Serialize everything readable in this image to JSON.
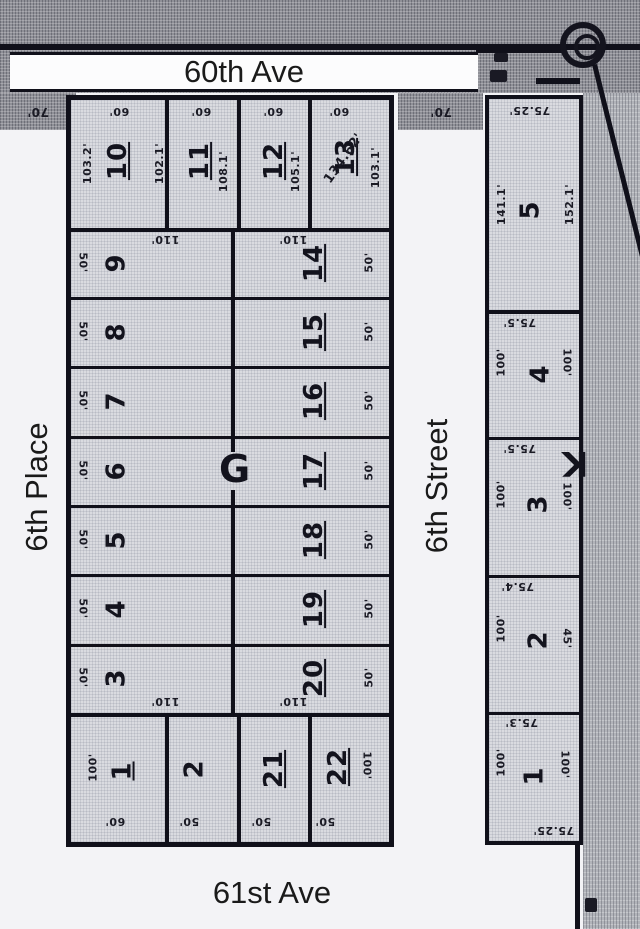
{
  "streets": {
    "top": "60th Ave",
    "west": "6th Place",
    "center": "6th Street",
    "bottom": "61st Ave"
  },
  "outer_dims": {
    "west_70": "70'",
    "center_70": "70'"
  },
  "block_g": {
    "label": "G",
    "north_row": [
      {
        "num": "10",
        "front": "60'",
        "west_depth": "103.2'",
        "east_depth": "102.1'"
      },
      {
        "num": "11",
        "front": "60'",
        "depth": "108.1'"
      },
      {
        "num": "12",
        "front": "60'",
        "depth": "105.1'"
      },
      {
        "num": "13",
        "front": "60'",
        "diagonal": "134.62'",
        "east_depth": "103.1'"
      }
    ],
    "west_lots": [
      {
        "num": "9",
        "front": "50'",
        "depth": "110'"
      },
      {
        "num": "8",
        "front": "50'"
      },
      {
        "num": "7",
        "front": "50'"
      },
      {
        "num": "6",
        "front": "50'"
      },
      {
        "num": "5",
        "front": "50'"
      },
      {
        "num": "4",
        "front": "50'"
      },
      {
        "num": "3",
        "front": "50'",
        "depth": "110'"
      }
    ],
    "east_lots": [
      {
        "num": "14",
        "front": "50'",
        "depth": "110'"
      },
      {
        "num": "15",
        "front": "50'"
      },
      {
        "num": "16",
        "front": "50'"
      },
      {
        "num": "17",
        "front": "50'"
      },
      {
        "num": "18",
        "front": "50'"
      },
      {
        "num": "19",
        "front": "50'"
      },
      {
        "num": "20",
        "front": "50'",
        "depth": "110'"
      }
    ],
    "south_row": [
      {
        "num": "1",
        "front": "60'",
        "side": "100'"
      },
      {
        "num": "2",
        "front": "50'"
      },
      {
        "num": "21",
        "front": "50'"
      },
      {
        "num": "22",
        "front": "50'",
        "side": "100'"
      }
    ]
  },
  "block_k": {
    "label": "K",
    "north_dim": "75.25'",
    "south_dim": "75.25'",
    "lots": [
      {
        "num": "5",
        "west": "141.1'",
        "east": "152.1'"
      },
      {
        "num": "4",
        "west": "100'",
        "east": "100'",
        "north_dim": "75.5'"
      },
      {
        "num": "3",
        "west": "100'",
        "east": "100'",
        "north_dim": "75.5'"
      },
      {
        "num": "2",
        "west": "100'",
        "east": "45'",
        "north_dim": "75.4'"
      },
      {
        "num": "1",
        "west": "100'",
        "east": "100'",
        "north_dim": "75.3'"
      }
    ]
  },
  "colors": {
    "ink": "#10101a",
    "paper": "#dadbe0",
    "photo_gray": "#8f9097",
    "street_white": "#f5f5f7"
  }
}
